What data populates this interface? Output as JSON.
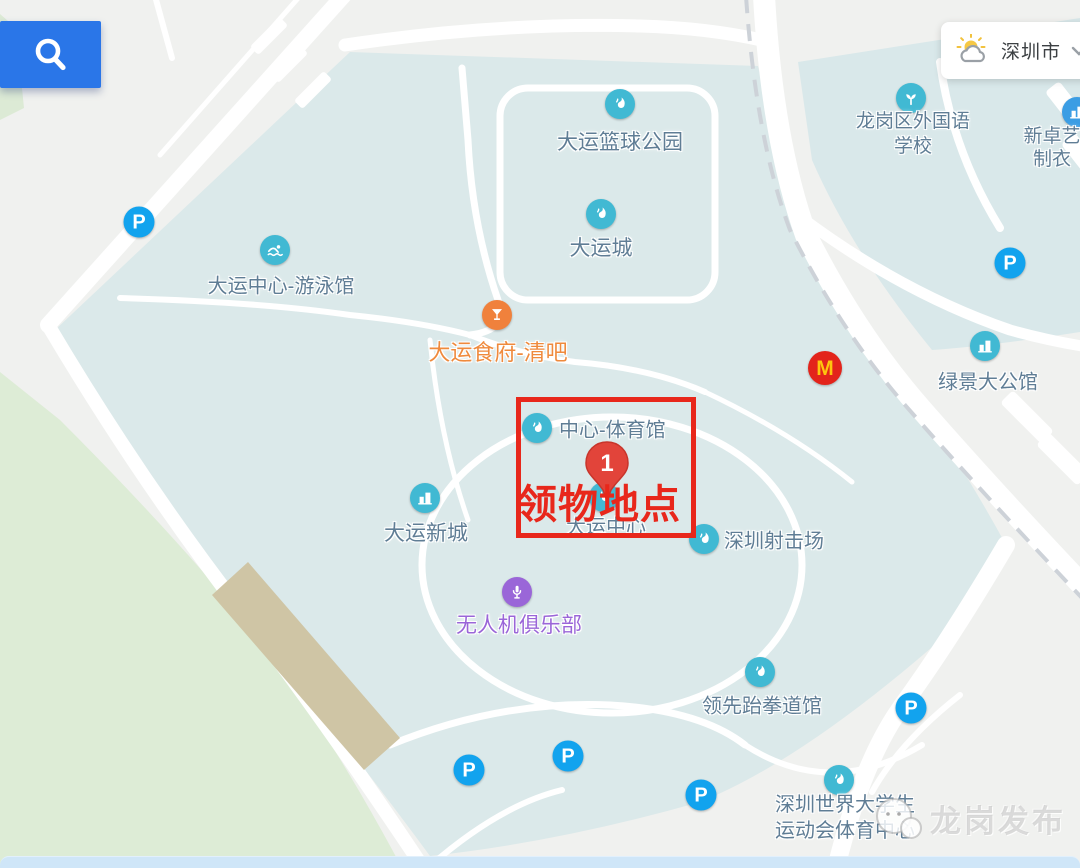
{
  "app": {
    "search_button": {
      "icon": "search"
    },
    "weather_widget": {
      "city": "深圳市",
      "icon": "sun-behind-cloud"
    }
  },
  "map": {
    "annotation": {
      "label": "领物地点",
      "marker_number": "1",
      "box": {
        "x": 516,
        "y": 397,
        "w": 180,
        "h": 141
      },
      "label_pos": {
        "x": 517,
        "y": 472
      },
      "marker_pos": {
        "x": 607,
        "y": 440
      }
    },
    "watermark": {
      "text": "龙岗发布"
    },
    "parking_letter": "P",
    "colors": {
      "poi_teal": "#41b9d3",
      "poi_blue": "#3b9de4",
      "poi_purple": "#9a66d8",
      "poi_orange": "#f0813c",
      "text_default": "#5f7d95",
      "text_orange": "#ef8a3d",
      "text_purple": "#9a66d8",
      "road_gray": "#8d9399",
      "road_gray_light": "#9aa1a7",
      "annotation_red": "#e8271b",
      "marker_red": "#e2443a",
      "parking_blue": "#12a3ee",
      "mcd_red": "#e3241b",
      "mcd_yellow": "#fec50e",
      "search_blue": "#2a76e8"
    },
    "pois": [
      {
        "name": "poi-dayun-basketball-park",
        "icon": "torch",
        "color": "poi_teal",
        "label": "大运篮球公园",
        "ix": 620,
        "iy": 104,
        "lx": 620,
        "ly": 141,
        "size": 21
      },
      {
        "name": "poi-dayun-city",
        "icon": "torch",
        "color": "poi_teal",
        "label": "大运城",
        "ix": 601,
        "iy": 214,
        "lx": 601,
        "ly": 247,
        "size": 21
      },
      {
        "name": "poi-longgang-foreign-language-school",
        "icon": "sprout",
        "color": "poi_teal",
        "lines": [
          "龙岗区外国语",
          "学校"
        ],
        "ix": 911,
        "iy": 98,
        "lx": 913,
        "ly": 134,
        "size": 19,
        "line_h": 25
      },
      {
        "name": "poi-xinzhuoyi-garment",
        "icon": "building",
        "color": "poi_blue",
        "lines": [
          "新卓艺",
          "制衣"
        ],
        "ix": 1077,
        "iy": 112,
        "lx": 1052,
        "ly": 148,
        "size": 19,
        "line_h": 23
      },
      {
        "name": "poi-dayun-center-swimming-hall",
        "icon": "swim",
        "color": "poi_teal",
        "label": "大运中心-游泳馆",
        "ix": 275,
        "iy": 250,
        "lx": 281,
        "ly": 284,
        "size": 20
      },
      {
        "name": "poi-dayun-restaurant-bar",
        "icon": "cocktail",
        "color": "poi_orange",
        "label": "大运食府-清吧",
        "text_color": "text_orange",
        "ix": 497,
        "iy": 315,
        "lx": 498,
        "ly": 351,
        "size": 22
      },
      {
        "name": "poi-mcdonalds",
        "icon": "mcd",
        "color": "mcd_red",
        "ix": 825,
        "iy": 368
      },
      {
        "name": "poi-lvjing-grand-mansion",
        "icon": "building",
        "color": "poi_teal",
        "label": "绿景大公馆",
        "ix": 985,
        "iy": 346,
        "lx": 988,
        "ly": 380,
        "size": 20
      },
      {
        "name": "poi-center-gymnasium",
        "icon": "torch",
        "color": "poi_teal",
        "label": "中心-体育馆",
        "layout": "right",
        "ix": 537,
        "iy": 428,
        "lx": 559,
        "ly": 428,
        "size": 20
      },
      {
        "name": "poi-dayun-center",
        "icon": "torch",
        "color": "poi_teal",
        "label": "大运中心",
        "ix": 604,
        "iy": 497,
        "lx": 606,
        "ly": 525,
        "size": 20
      },
      {
        "name": "poi-shenzhen-shooting-range",
        "icon": "torch",
        "color": "poi_teal",
        "label": "深圳射击场",
        "layout": "right",
        "ix": 704,
        "iy": 539,
        "lx": 724,
        "ly": 539,
        "size": 20
      },
      {
        "name": "poi-dayun-new-town",
        "icon": "building",
        "color": "poi_teal",
        "label": "大运新城",
        "ix": 425,
        "iy": 498,
        "lx": 426,
        "ly": 532,
        "size": 21
      },
      {
        "name": "poi-drone-club",
        "icon": "mic",
        "color": "poi_purple",
        "label": "无人机俱乐部",
        "text_color": "text_purple",
        "ix": 517,
        "iy": 592,
        "lx": 519,
        "ly": 624,
        "size": 21
      },
      {
        "name": "poi-lingxian-taekwondo-hall",
        "icon": "torch",
        "color": "poi_teal",
        "label": "领先跆拳道馆",
        "ix": 760,
        "iy": 672,
        "lx": 762,
        "ly": 704,
        "size": 20
      },
      {
        "name": "poi-universiade-sports-center",
        "icon": "torch",
        "color": "poi_teal",
        "lines": [
          "深圳世界大学生",
          "运动会体育中心"
        ],
        "ix": 839,
        "iy": 780,
        "lx": 845,
        "ly": 818,
        "size": 20,
        "line_h": 26
      }
    ],
    "road_labels": [
      {
        "name": "road-label-dayun-road",
        "text": "大运路",
        "x": 620,
        "y": 13,
        "size": 20,
        "color": "road_gray"
      },
      {
        "name": "road-label-huangge-road",
        "text": "黄阁路",
        "x": 764,
        "y": 140,
        "size": 20,
        "color": "road_gray",
        "vertical": true
      },
      {
        "name": "label-metro-line16",
        "lines": [
          "16号线(龙坪",
          "线)(在建)"
        ],
        "x": 822,
        "y": 298,
        "size": 18,
        "line_h": 25,
        "color": "road_gray"
      },
      {
        "name": "label-building-8",
        "text": "8栋",
        "x": 1032,
        "y": 440,
        "size": 15,
        "color": "road_gray_light"
      },
      {
        "name": "label-jin-truncated",
        "text": "金",
        "x": 1066,
        "y": 254,
        "size": 20,
        "color": "text_default"
      },
      {
        "name": "road-label-dayun-truncated",
        "text": "大运",
        "x": 1062,
        "y": 578,
        "size": 20,
        "color": "road_gray"
      }
    ],
    "parking_markers": [
      {
        "x": 139,
        "y": 222
      },
      {
        "x": 1010,
        "y": 263
      },
      {
        "x": 911,
        "y": 708
      },
      {
        "x": 469,
        "y": 770
      },
      {
        "x": 568,
        "y": 756
      },
      {
        "x": 701,
        "y": 795
      }
    ]
  }
}
